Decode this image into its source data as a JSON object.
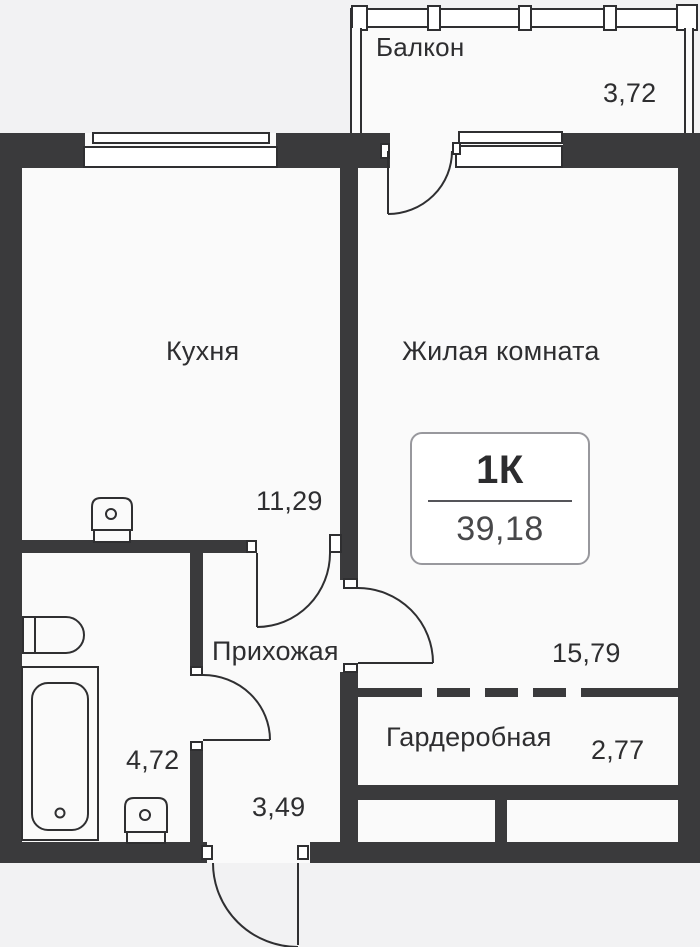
{
  "badge": {
    "type": "1К",
    "total_area": "39,18"
  },
  "rooms": {
    "balcony": {
      "label": "Балкон",
      "area": "3,72"
    },
    "kitchen": {
      "label": "Кухня",
      "area": "11,29"
    },
    "living": {
      "label": "Жилая комната",
      "area": "15,79"
    },
    "hallway": {
      "label": "Прихожая",
      "area": "3,49"
    },
    "bathroom": {
      "area": "4,72"
    },
    "wardrobe": {
      "label": "Гардеробная",
      "area": "2,77"
    }
  },
  "icons": {
    "fixtures": [
      "bathtub-icon",
      "toilet-icon",
      "bathroom-sink-icon",
      "kitchen-sink-icon"
    ],
    "doors": [
      "entrance-door",
      "balcony-door",
      "kitchen-door",
      "living-room-door",
      "bathroom-door"
    ]
  },
  "colors": {
    "wall": "#3a3a3c",
    "line": "#2f2f31",
    "room_fill": "#fafafa",
    "background": "#f2f2f3",
    "text": "#2e2e30",
    "badge_border": "#98989d"
  }
}
